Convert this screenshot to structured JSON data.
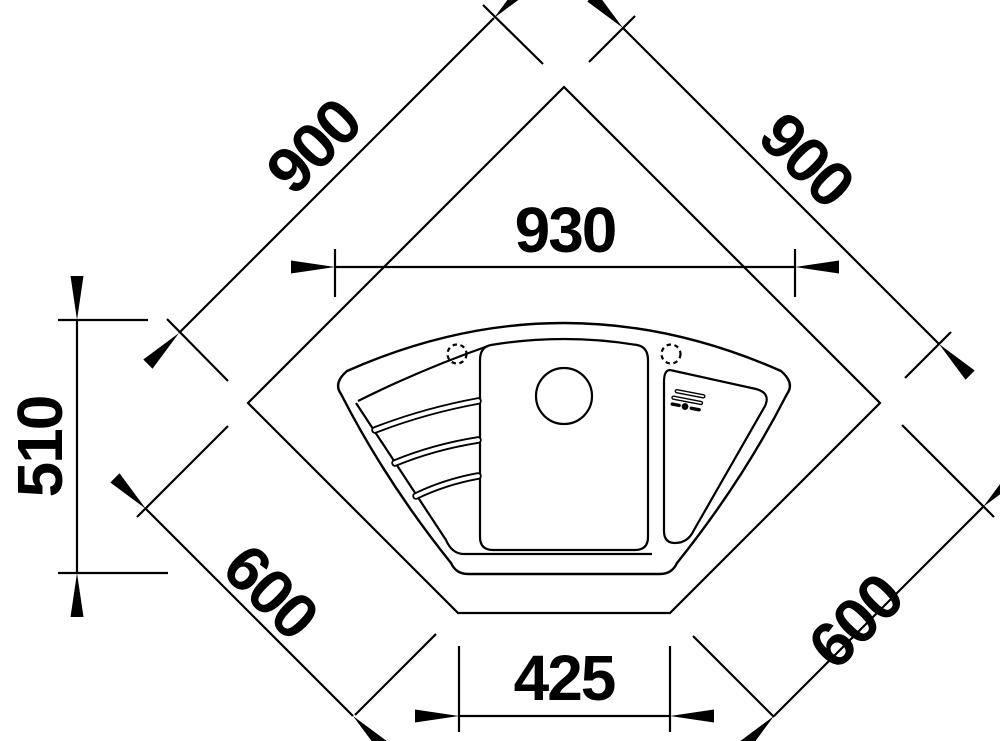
{
  "drawing": {
    "title": "corner-sink-top-view-technical-drawing",
    "unit": "mm",
    "colors": {
      "line": "#000000",
      "background": "#ffffff"
    },
    "dimensions": {
      "depth_left": "900",
      "depth_right": "900",
      "width_overall": "930",
      "depth_overall": "510",
      "cabinet_left": "600",
      "cabinet_right": "600",
      "front_edge": "425"
    },
    "features": {
      "countertop": "pentagon-corner-countertop-outline",
      "rim": "sink-outer-rim",
      "basin": "sink-inner-basin",
      "bowl": "main-bowl",
      "drain": "drain-hole",
      "ribs": "drainer-ribs",
      "tap_left": "tap-hole-left",
      "tap_right": "tap-hole-right",
      "control": "remote-drain-control"
    }
  }
}
